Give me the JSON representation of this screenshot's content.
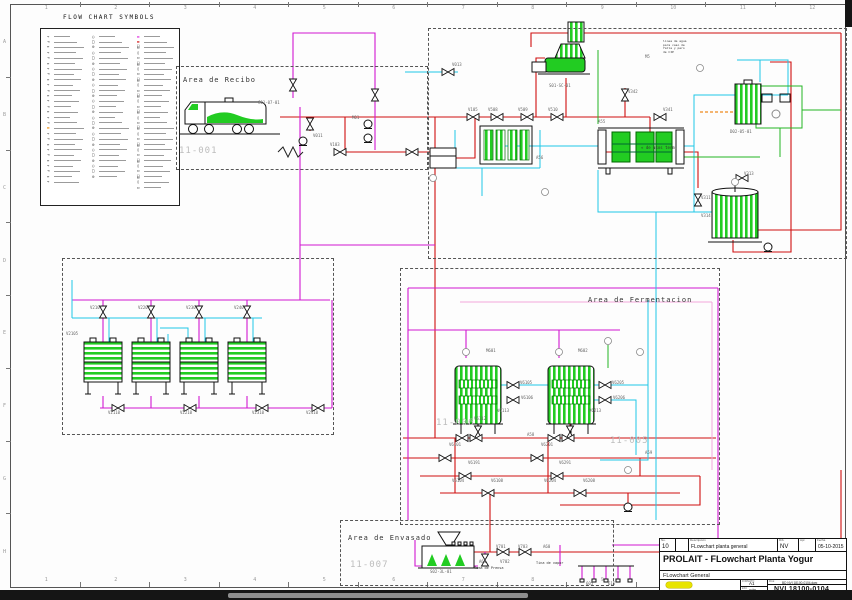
{
  "sheet": {
    "cols": [
      "1",
      "2",
      "3",
      "4",
      "5",
      "6",
      "7",
      "8",
      "9",
      "10",
      "11",
      "12"
    ],
    "rows": [
      "A",
      "B",
      "C",
      "D",
      "E",
      "F",
      "G",
      "H"
    ]
  },
  "legend": {
    "title": "FLOW CHART SYMBOLS",
    "columns": [
      {
        "rows": 28
      },
      {
        "rows": 27
      },
      {
        "rows": 29
      }
    ],
    "accents": {
      "0": {
        "17": "#ee8800"
      },
      "2": {
        "0": "#dd22dd",
        "1": "#cc0000"
      }
    }
  },
  "areas": {
    "recibo": {
      "label": "Area de Recibo",
      "number": "11-001"
    },
    "fermentacion": {
      "label": "Area de Fermentacion",
      "number_left": "11-006",
      "number_right": "11-005"
    },
    "envasado": {
      "label": "Area de Envasado",
      "number": "11-007"
    }
  },
  "notes": [
    {
      "x": 663,
      "y": 40,
      "size": 3,
      "lines": [
        "linea de agua",
        "para caso de",
        "falla y paro",
        "de CIP"
      ]
    },
    {
      "x": 641,
      "y": 146,
      "size": 4,
      "lines": [
        "« de usos term."
      ]
    },
    {
      "x": 474,
      "y": 566,
      "size": 3.5,
      "lines": [
        "Toma de Prensa"
      ]
    },
    {
      "x": 536,
      "y": 561,
      "size": 3.5,
      "lines": [
        "Tina de vapor"
      ]
    }
  ],
  "tags": [
    [
      "C01-07-01",
      258,
      101
    ],
    [
      "V011",
      313,
      134
    ],
    [
      "M01",
      352,
      116
    ],
    [
      "V103",
      330,
      143
    ],
    [
      "V105",
      468,
      108
    ],
    [
      "V013",
      452,
      63
    ],
    [
      "V508",
      488,
      108
    ],
    [
      "V509",
      518,
      108
    ],
    [
      "V510",
      548,
      108
    ],
    [
      "V342",
      628,
      90
    ],
    [
      "V341",
      663,
      108
    ],
    [
      "M5",
      645,
      55
    ],
    [
      "V311",
      701,
      196
    ],
    [
      "V313",
      744,
      172
    ],
    [
      "V314",
      701,
      214
    ],
    [
      "D02-05-01",
      730,
      130
    ],
    [
      "S01-SC-01",
      549,
      84
    ],
    [
      "A55",
      598,
      120
    ],
    [
      "A56",
      536,
      156
    ],
    [
      "V2101",
      90,
      306
    ],
    [
      "V2201",
      138,
      306
    ],
    [
      "V2301",
      186,
      306
    ],
    [
      "V2401",
      234,
      306
    ],
    [
      "V2110",
      108,
      411
    ],
    [
      "V2210",
      180,
      411
    ],
    [
      "V2310",
      252,
      411
    ],
    [
      "V2410",
      306,
      411
    ],
    [
      "V2105",
      66,
      332
    ],
    [
      "M601",
      486,
      349
    ],
    [
      "M602",
      578,
      349
    ],
    [
      "V6105",
      520,
      381
    ],
    [
      "V6106",
      521,
      396
    ],
    [
      "V6205",
      612,
      381
    ],
    [
      "V6206",
      613,
      396
    ],
    [
      "V6113",
      497,
      409
    ],
    [
      "V6112",
      474,
      417
    ],
    [
      "V6213",
      589,
      409
    ],
    [
      "V6101",
      449,
      443
    ],
    [
      "V6201",
      541,
      443
    ],
    [
      "V6191",
      468,
      461
    ],
    [
      "V6291",
      559,
      461
    ],
    [
      "V6104",
      452,
      479
    ],
    [
      "V6108",
      491,
      479
    ],
    [
      "V6204",
      544,
      479
    ],
    [
      "V6208",
      583,
      479
    ],
    [
      "A58",
      527,
      433
    ],
    [
      "A59",
      645,
      451
    ],
    [
      "V701",
      496,
      545
    ],
    [
      "V703",
      518,
      545
    ],
    [
      "V702",
      500,
      560
    ],
    [
      "A61",
      479,
      560
    ],
    [
      "A60",
      543,
      545
    ],
    [
      "605",
      586,
      582
    ],
    [
      "615",
      608,
      582
    ],
    [
      "S02-3L-01",
      430,
      570
    ]
  ],
  "valves": [
    [
      448,
      72,
      0
    ],
    [
      473,
      117,
      0
    ],
    [
      497,
      117,
      0
    ],
    [
      527,
      117,
      0
    ],
    [
      557,
      117,
      0
    ],
    [
      625,
      95,
      90
    ],
    [
      660,
      117,
      0
    ],
    [
      698,
      200,
      90
    ],
    [
      742,
      178,
      0
    ],
    [
      310,
      124,
      90
    ],
    [
      340,
      152,
      0
    ],
    [
      412,
      152,
      0
    ],
    [
      375,
      95,
      90
    ],
    [
      293,
      85,
      90
    ],
    [
      103,
      312,
      90
    ],
    [
      151,
      312,
      90
    ],
    [
      199,
      312,
      90
    ],
    [
      247,
      312,
      90
    ],
    [
      118,
      408,
      0
    ],
    [
      190,
      408,
      0
    ],
    [
      262,
      408,
      0
    ],
    [
      318,
      408,
      0
    ],
    [
      513,
      385,
      0
    ],
    [
      513,
      400,
      0
    ],
    [
      605,
      385,
      0
    ],
    [
      605,
      400,
      0
    ],
    [
      478,
      432,
      90
    ],
    [
      570,
      432,
      90
    ],
    [
      462,
      438,
      0
    ],
    [
      476,
      438,
      0
    ],
    [
      554,
      438,
      0
    ],
    [
      568,
      438,
      0
    ],
    [
      445,
      458,
      0
    ],
    [
      537,
      458,
      0
    ],
    [
      465,
      476,
      0
    ],
    [
      557,
      476,
      0
    ],
    [
      488,
      493,
      0
    ],
    [
      580,
      493,
      0
    ],
    [
      503,
      552,
      0
    ],
    [
      525,
      552,
      0
    ],
    [
      485,
      560,
      90
    ]
  ],
  "pumps": [
    [
      303,
      141
    ],
    [
      368,
      124
    ],
    [
      368,
      138
    ],
    [
      768,
      247
    ],
    [
      628,
      507
    ]
  ],
  "instruments": [
    [
      433,
      178
    ],
    [
      545,
      192
    ],
    [
      640,
      352
    ],
    [
      700,
      68
    ],
    [
      628,
      470
    ],
    [
      466,
      352
    ],
    [
      559,
      352
    ],
    [
      735,
      182
    ],
    [
      608,
      341
    ]
  ],
  "title_block": {
    "rev_row": {
      "headers": {
        "no": "No.",
        "desc": "Descripción",
        "by": "Dib.",
        "appr": "Apr.",
        "date": "Fecha"
      },
      "no": "10",
      "desc": "FLowchart planta general",
      "by": "NV",
      "appr": "",
      "date": "05-10-2015"
    },
    "title": "PROLAIT - FLowchart Planta Yogur",
    "subtitle": "FLowchart General",
    "format_label": "FORMATO",
    "format": "A1",
    "scale_label": "ESC",
    "scale": "S/E",
    "file_label": "FILE",
    "file": "BD NVI 18100-0104.dwg",
    "dwg_no": "NVI 18100-0104",
    "logo_sub": "PROLAIT"
  },
  "colors": {
    "product_line": "#cf1010",
    "culture_line": "#d118d1",
    "cip_line": "#1ec8e6",
    "service_line": "#23b523",
    "steam_line": "#f08a1e",
    "equipment_fill": "#22cc22"
  }
}
